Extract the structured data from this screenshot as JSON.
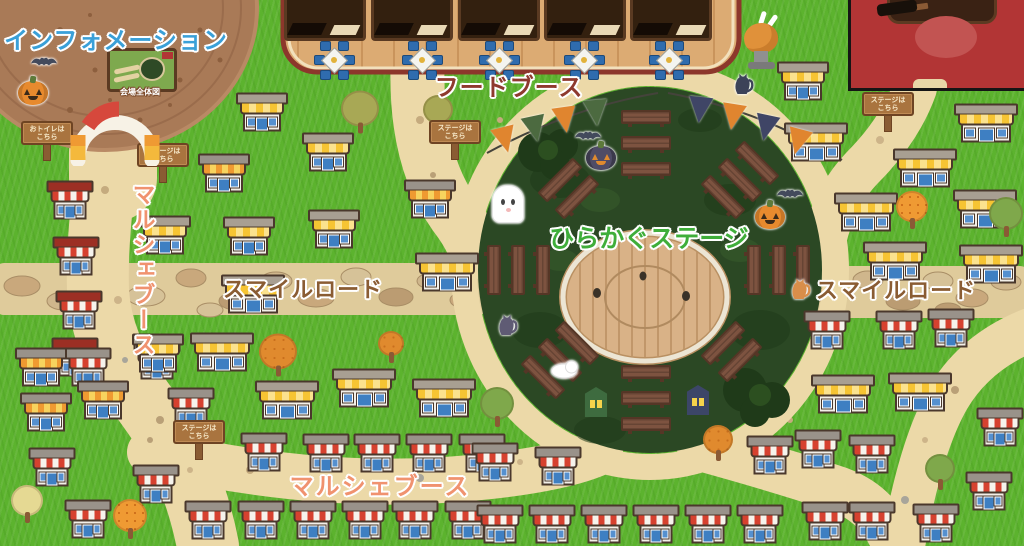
{
  "labels": {
    "information": "インフォメーション",
    "map_caption": "会場全体図",
    "food_booth": "フードブース",
    "stage": "ひらかぐステージ",
    "smile_road_left": "スマイルロード",
    "smile_road_right": "スマイルロード",
    "marche_left": "マルシェブース",
    "marche_bottom": "マルシェブース"
  },
  "colors": {
    "grass": "#5cb32e",
    "path": "#ecd9a8",
    "dirt": "#a97a57",
    "stage_green": "#2b4824",
    "stage_wood": "#d9b287",
    "deck_wood": "#dcab73",
    "deck_border": "#8c372b",
    "title_blue": "#3aa0d8",
    "food_text_red": "#8e3a2e",
    "stage_text_green": "#3fae3a",
    "smile_text_brown": "#8a5c33",
    "marche_text_salmon": "#f0926f",
    "flag_orange": "#e0852f",
    "flag_green": "#4c6a40",
    "flag_navy": "#3f4566"
  },
  "signs": [
    {
      "x": 47,
      "y": 141,
      "line1": "おトイレは",
      "line2": "こちら"
    },
    {
      "x": 163,
      "y": 163,
      "line1": "ステージは",
      "line2": "こちら"
    },
    {
      "x": 455,
      "y": 140,
      "line1": "ステージは",
      "line2": "こちら"
    },
    {
      "x": 199,
      "y": 440,
      "line1": "ステージは",
      "line2": "こちら"
    },
    {
      "x": 888,
      "y": 112,
      "line1": "ステージは",
      "line2": "こちら"
    }
  ],
  "food_court": {
    "booth_xs": [
      325,
      412,
      499,
      585,
      671
    ],
    "table_xs": [
      334,
      422,
      499,
      584,
      669
    ],
    "table_y": 60
  },
  "houses": [
    [
      70,
      200,
      "d"
    ],
    [
      76,
      256,
      "d"
    ],
    [
      79,
      310,
      "d"
    ],
    [
      75,
      357,
      "d"
    ],
    [
      88,
      367,
      "r"
    ],
    [
      157,
      360,
      "r"
    ],
    [
      191,
      407,
      "r"
    ],
    [
      52,
      467,
      "r"
    ],
    [
      88,
      519,
      "r"
    ],
    [
      156,
      484,
      "r"
    ],
    [
      264,
      452,
      "r"
    ],
    [
      326,
      453,
      "r"
    ],
    [
      377,
      453,
      "r"
    ],
    [
      429,
      453,
      "r"
    ],
    [
      482,
      453,
      "r"
    ],
    [
      208,
      520,
      "r"
    ],
    [
      261,
      520,
      "r"
    ],
    [
      313,
      520,
      "r"
    ],
    [
      365,
      520,
      "r"
    ],
    [
      415,
      520,
      "r"
    ],
    [
      468,
      520,
      "r"
    ],
    [
      495,
      462,
      "r"
    ],
    [
      558,
      466,
      "r"
    ],
    [
      500,
      524,
      "r"
    ],
    [
      552,
      524,
      "r"
    ],
    [
      604,
      524,
      "r"
    ],
    [
      656,
      524,
      "r"
    ],
    [
      708,
      524,
      "r"
    ],
    [
      760,
      524,
      "r"
    ],
    [
      770,
      455,
      "r"
    ],
    [
      818,
      449,
      "r"
    ],
    [
      827,
      330,
      "r"
    ],
    [
      899,
      330,
      "r"
    ],
    [
      951,
      328,
      "r"
    ],
    [
      1000,
      427,
      "r"
    ],
    [
      872,
      454,
      "r"
    ],
    [
      989,
      491,
      "r"
    ],
    [
      872,
      521,
      "r"
    ],
    [
      936,
      523,
      "r"
    ],
    [
      825,
      521,
      "r"
    ],
    [
      224,
      173,
      "o"
    ],
    [
      430,
      199,
      "o"
    ],
    [
      41,
      367,
      "o"
    ],
    [
      46,
      412,
      "o"
    ],
    [
      103,
      400,
      "o"
    ],
    [
      262,
      112,
      "y"
    ],
    [
      328,
      152,
      "y"
    ],
    [
      165,
      235,
      "y"
    ],
    [
      249,
      236,
      "y"
    ],
    [
      334,
      229,
      "y"
    ],
    [
      158,
      353,
      "y"
    ],
    [
      803,
      81,
      "y"
    ],
    [
      253,
      294,
      "Y"
    ],
    [
      222,
      352,
      "Y"
    ],
    [
      287,
      400,
      "Y"
    ],
    [
      364,
      388,
      "Y"
    ],
    [
      444,
      398,
      "Y"
    ],
    [
      447,
      272,
      "Y"
    ],
    [
      816,
      142,
      "Y"
    ],
    [
      925,
      168,
      "Y"
    ],
    [
      866,
      212,
      "Y"
    ],
    [
      985,
      209,
      "Y"
    ],
    [
      895,
      261,
      "Y"
    ],
    [
      991,
      264,
      "Y"
    ],
    [
      986,
      123,
      "Y"
    ],
    [
      843,
      394,
      "Y"
    ],
    [
      920,
      392,
      "Y"
    ]
  ],
  "trees": [
    [
      360,
      112,
      "olive",
      34
    ],
    [
      438,
      113,
      "olive",
      26
    ],
    [
      278,
      355,
      "autumn",
      34
    ],
    [
      391,
      347,
      "autumn",
      22
    ],
    [
      130,
      519,
      "dotted",
      30
    ],
    [
      27,
      504,
      "pale",
      28
    ],
    [
      497,
      407,
      "green",
      30
    ],
    [
      912,
      210,
      "dotted",
      28
    ],
    [
      940,
      472,
      "green",
      26
    ],
    [
      1006,
      217,
      "green",
      30
    ],
    [
      718,
      443,
      "autumn",
      26
    ]
  ],
  "benches": [
    [
      646,
      117,
      0
    ],
    [
      646,
      143,
      0
    ],
    [
      646,
      169,
      0
    ],
    [
      646,
      372,
      0
    ],
    [
      646,
      398,
      0
    ],
    [
      646,
      424,
      0
    ],
    [
      754,
      270,
      90
    ],
    [
      779,
      270,
      90
    ],
    [
      803,
      270,
      90
    ],
    [
      543,
      270,
      90
    ],
    [
      518,
      270,
      90
    ],
    [
      494,
      270,
      90
    ],
    [
      723,
      197,
      45
    ],
    [
      740,
      180,
      45
    ],
    [
      757,
      163,
      45
    ],
    [
      723,
      343,
      -45
    ],
    [
      740,
      360,
      -45
    ],
    [
      577,
      343,
      45
    ],
    [
      560,
      360,
      45
    ],
    [
      543,
      377,
      45
    ],
    [
      577,
      197,
      -45
    ],
    [
      560,
      180,
      -45
    ]
  ],
  "flags": [
    [
      505,
      127,
      "#e0852f",
      -14
    ],
    [
      535,
      116,
      "#4c6a40",
      -12
    ],
    [
      565,
      107,
      "#e0852f",
      -8
    ],
    [
      596,
      100,
      "#4c6a40",
      -5
    ],
    [
      700,
      97,
      "#3f4566",
      6
    ],
    [
      733,
      104,
      "#e0852f",
      9
    ],
    [
      766,
      115,
      "#3f4566",
      12
    ],
    [
      798,
      129,
      "#e0852f",
      15
    ]
  ],
  "decorations": [
    [
      "bat",
      44,
      64
    ],
    [
      "pumpkin",
      33,
      93
    ],
    [
      "ghost",
      508,
      204
    ],
    [
      "bat",
      588,
      138
    ],
    [
      "pumpkin-purple",
      601,
      158
    ],
    [
      "pumpkin",
      770,
      217
    ],
    [
      "bat",
      790,
      196
    ],
    [
      "cat-black",
      743,
      85
    ],
    [
      "cat-purple",
      507,
      326
    ],
    [
      "cat-white",
      564,
      371
    ],
    [
      "cat-orange",
      800,
      290
    ],
    [
      "lantern-green",
      596,
      402
    ],
    [
      "lantern-navy",
      698,
      400
    ],
    [
      "turkey",
      762,
      42
    ]
  ]
}
